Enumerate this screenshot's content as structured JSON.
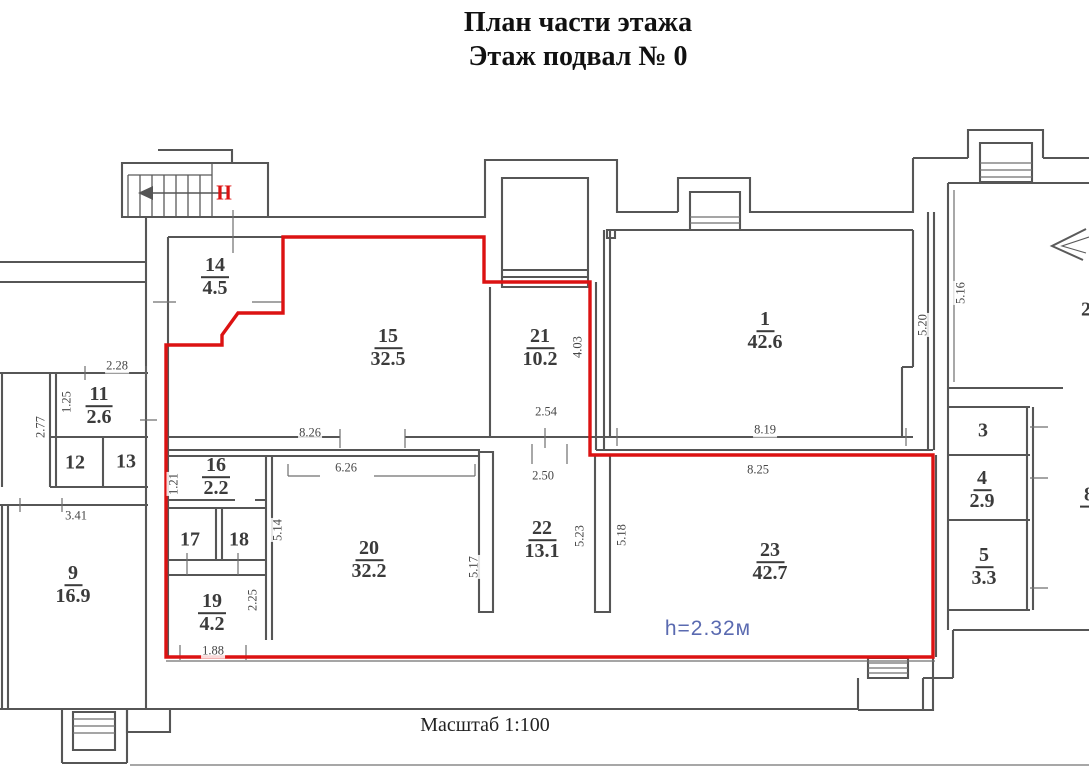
{
  "title": {
    "line1": "План части этажа",
    "line2": "Этаж подвал № 0"
  },
  "scale_note": "Масштаб 1:100",
  "stairwell_label": "II",
  "height_note": "h=2.32м",
  "colors": {
    "boundary_red": "#dc1212",
    "wall_gray": "#565656",
    "thin_gray": "#6f6f6f",
    "note_blue": "#5a6ab0",
    "label_text": "#3b3b3b"
  },
  "rooms": [
    {
      "num": "14",
      "area": "4.5",
      "bar": true,
      "x": 215,
      "y": 277
    },
    {
      "num": "15",
      "area": "32.5",
      "bar": true,
      "x": 388,
      "y": 348
    },
    {
      "num": "21",
      "area": "10.2",
      "bar": true,
      "x": 540,
      "y": 348
    },
    {
      "num": "1",
      "area": "42.6",
      "bar": true,
      "x": 765,
      "y": 331
    },
    {
      "num": "11",
      "area": "2.6",
      "bar": true,
      "x": 99,
      "y": 406
    },
    {
      "num": "12",
      "area": "",
      "bar": false,
      "x": 75,
      "y": 463
    },
    {
      "num": "13",
      "area": "",
      "bar": false,
      "x": 126,
      "y": 462
    },
    {
      "num": "9",
      "area": "16.9",
      "bar": true,
      "x": 73,
      "y": 585
    },
    {
      "num": "16",
      "area": "2.2",
      "bar": true,
      "x": 216,
      "y": 477
    },
    {
      "num": "17",
      "area": "",
      "bar": false,
      "x": 190,
      "y": 540
    },
    {
      "num": "18",
      "area": "",
      "bar": false,
      "x": 239,
      "y": 540
    },
    {
      "num": "19",
      "area": "4.2",
      "bar": true,
      "x": 212,
      "y": 613
    },
    {
      "num": "20",
      "area": "32.2",
      "bar": true,
      "x": 369,
      "y": 560
    },
    {
      "num": "22",
      "area": "13.1",
      "bar": true,
      "x": 542,
      "y": 540
    },
    {
      "num": "23",
      "area": "42.7",
      "bar": true,
      "x": 770,
      "y": 562
    },
    {
      "num": "3",
      "area": "",
      "bar": false,
      "x": 983,
      "y": 431
    },
    {
      "num": "4",
      "area": "2.9",
      "bar": true,
      "x": 982,
      "y": 490
    },
    {
      "num": "5",
      "area": "3.3",
      "bar": true,
      "x": 984,
      "y": 567
    },
    {
      "num": "2",
      "area": "",
      "bar": false,
      "x": 1086,
      "y": 310
    },
    {
      "num": "8",
      "area": "",
      "bar": true,
      "x": 1089,
      "y": 496
    }
  ],
  "dimensions": [
    {
      "value": "2.28",
      "x": 117,
      "y": 366,
      "rot": false
    },
    {
      "value": "1.25",
      "x": 67,
      "y": 402,
      "rot": true
    },
    {
      "value": "2.77",
      "x": 41,
      "y": 427,
      "rot": true
    },
    {
      "value": "3.41",
      "x": 76,
      "y": 516,
      "rot": false
    },
    {
      "value": "8.26",
      "x": 310,
      "y": 433,
      "rot": false
    },
    {
      "value": "6.26",
      "x": 346,
      "y": 468,
      "rot": false
    },
    {
      "value": "2.54",
      "x": 546,
      "y": 412,
      "rot": false
    },
    {
      "value": "2.50",
      "x": 543,
      "y": 476,
      "rot": false
    },
    {
      "value": "4.03",
      "x": 578,
      "y": 347,
      "rot": true
    },
    {
      "value": "8.19",
      "x": 765,
      "y": 430,
      "rot": false
    },
    {
      "value": "8.25",
      "x": 758,
      "y": 470,
      "rot": false
    },
    {
      "value": "5.20",
      "x": 923,
      "y": 325,
      "rot": true
    },
    {
      "value": "5.16",
      "x": 961,
      "y": 293,
      "rot": true
    },
    {
      "value": "1.21",
      "x": 174,
      "y": 484,
      "rot": true
    },
    {
      "value": "5.14",
      "x": 278,
      "y": 530,
      "rot": true
    },
    {
      "value": "2.25",
      "x": 253,
      "y": 600,
      "rot": true
    },
    {
      "value": "1.88",
      "x": 213,
      "y": 651,
      "rot": false
    },
    {
      "value": "5.17",
      "x": 474,
      "y": 567,
      "rot": true
    },
    {
      "value": "5.23",
      "x": 580,
      "y": 536,
      "rot": true
    },
    {
      "value": "5.18",
      "x": 622,
      "y": 535,
      "rot": true
    }
  ]
}
